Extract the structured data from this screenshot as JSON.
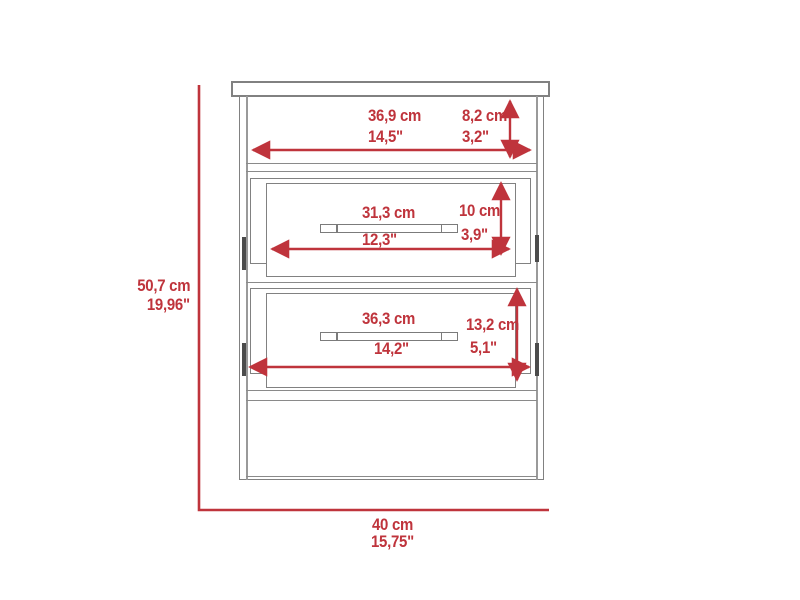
{
  "diagram": {
    "colors": {
      "dimension_red": "#bf343c",
      "outline_gray": "#818181"
    },
    "dimensions": {
      "overall_height": {
        "cm": "50,7 cm",
        "inches": "19,96\""
      },
      "overall_width": {
        "cm": "40 cm",
        "inches": "15,75\""
      },
      "top_shelf_width": {
        "cm": "36,9 cm",
        "inches": "14,5\""
      },
      "top_shelf_height": {
        "cm": "8,2 cm",
        "inches": "3,2\""
      },
      "upper_drawer_width": {
        "cm": "31,3 cm",
        "inches": "12,3\""
      },
      "upper_drawer_height": {
        "cm": "10 cm",
        "inches": "3,9\""
      },
      "lower_drawer_width": {
        "cm": "36,3 cm",
        "inches": "14,2\""
      },
      "lower_drawer_height": {
        "cm": "13,2 cm",
        "inches": "5,1\""
      }
    }
  }
}
